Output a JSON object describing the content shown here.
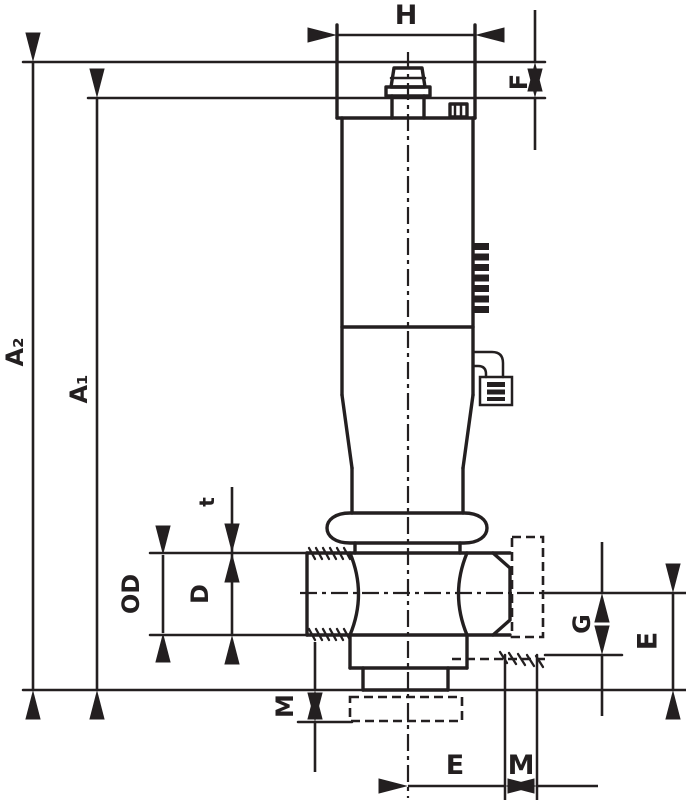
{
  "drawing": {
    "type": "valve-dimensional-outline-drawing",
    "line_color": "#231f20",
    "background": "#ffffff",
    "labels": {
      "h": "H",
      "f": "F",
      "a2": "A₂",
      "a1": "A₁",
      "t": "t",
      "od": "OD",
      "d": "D",
      "m_left": "M",
      "g": "G",
      "e_right": "E",
      "e_bottom": "E",
      "m_bottom": "M"
    }
  }
}
